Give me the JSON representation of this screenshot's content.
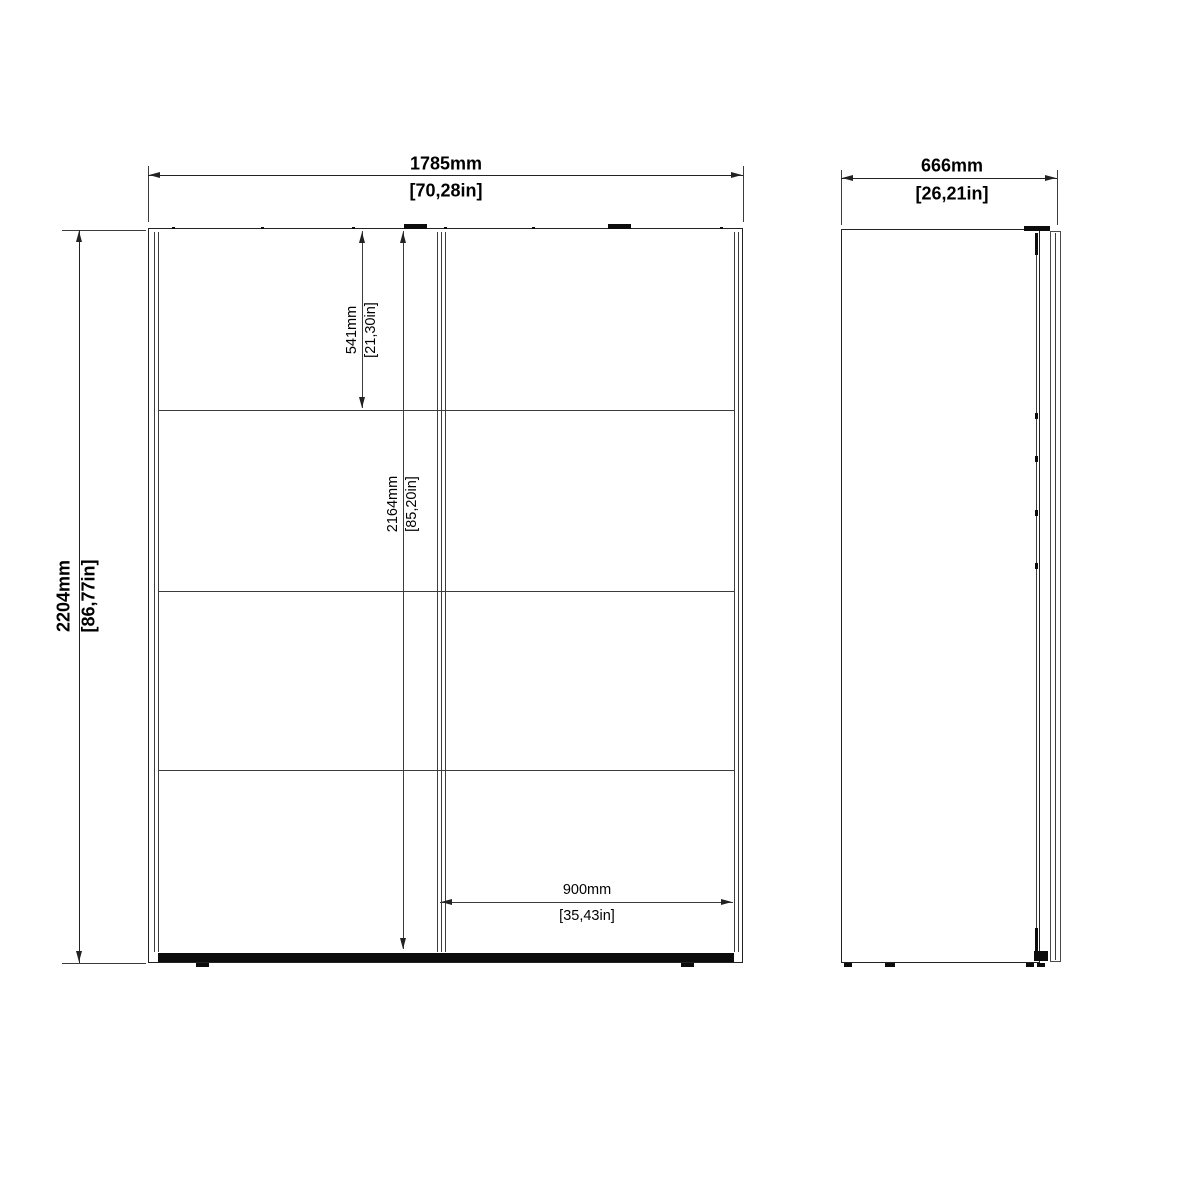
{
  "front_view": {
    "overall_width_mm": "1785mm",
    "overall_width_in": "[70,28in]",
    "overall_height_mm": "2204mm",
    "overall_height_in": "[86,77in]",
    "top_section_mm": "541mm",
    "top_section_in": "[21,30in]",
    "interior_height_mm": "2164mm",
    "interior_height_in": "[85,20in]",
    "door_width_mm": "900mm",
    "door_width_in": "[35,43in]"
  },
  "side_view": {
    "depth_mm": "666mm",
    "depth_in": "[26,21in]"
  },
  "colors": {
    "background": "#ffffff",
    "line": "#3c3c3c",
    "outline": "#222222",
    "hardware": "#0c0c0c",
    "text": "#000000"
  }
}
